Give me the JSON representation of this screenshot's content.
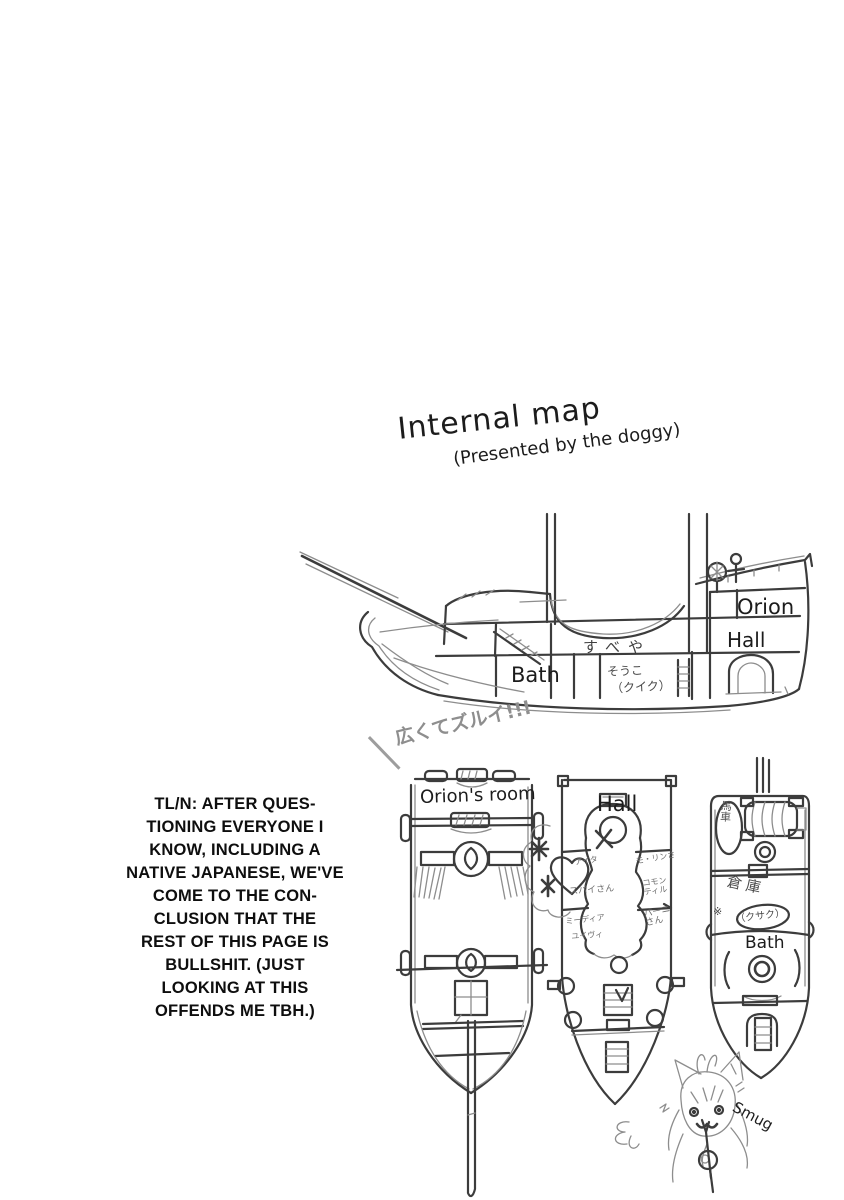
{
  "page": {
    "title": "Internal map",
    "subtitle": "(Presented by the doggy)"
  },
  "side_view": {
    "exclamation": "広くてズルイ!!!",
    "rooms": {
      "orion": "Orion",
      "hall": "Hall",
      "bath": "Bath",
      "cabin_jp": "すべや",
      "storage_jp": "そうこ",
      "storage_note_jp": "（クイク）"
    }
  },
  "translator_note": {
    "lines": [
      "TL/N: AFTER QUES-",
      "TIONING EVERYONE I",
      "KNOW, INCLUDING A",
      "NATIVE JAPANESE, WE'VE",
      "COME TO THE CON-",
      "CLUSION THAT THE",
      "REST OF THIS PAGE IS",
      "BULLSHIT. (JUST",
      "LOOKING AT THIS",
      "OFFENDS ME TBH.)"
    ]
  },
  "deck_plans": {
    "left": {
      "label": "Orion's room"
    },
    "middle": {
      "label": "Hall",
      "scribbles": [
        "アイタ",
        "スパイさん",
        "ミーディア",
        "ユイヴィ",
        "モ・リンさ",
        "コモン\nティル",
        "パーニ\nさん"
      ]
    },
    "right": {
      "cart_jp": "馬車",
      "storage_jp": "倉庫",
      "ref_mark": "※",
      "storage_note_jp": "（クサク）",
      "bath": "Bath"
    }
  },
  "mascot": {
    "label": "Smug"
  }
}
